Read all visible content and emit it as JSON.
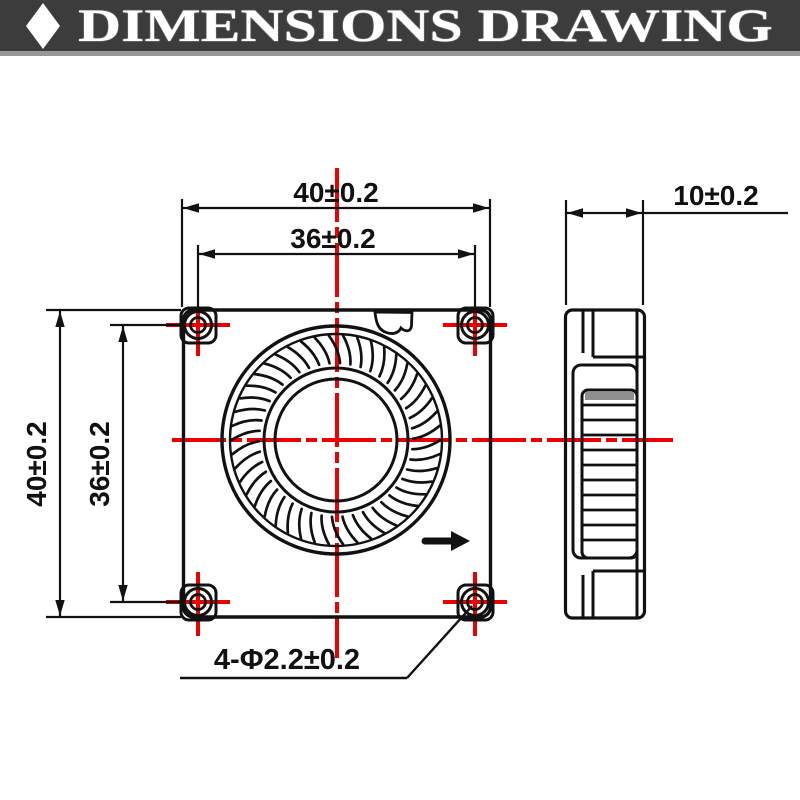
{
  "header": {
    "title": "DIMENSIONS DRAWING"
  },
  "front_view": {
    "width_label": "40±0.2",
    "hole_spacing_width_label": "36±0.2",
    "height_label": "40±0.2",
    "hole_spacing_height_label": "36±0.2",
    "mounting_holes_label": "4-Φ2.2±0.2"
  },
  "side_view": {
    "depth_label": "10±0.2"
  },
  "colors": {
    "centerline_red": "#ee0000",
    "drawing_black": "#111111",
    "header_background": "#3c3c3c",
    "header_divider_gray": "#979797"
  }
}
